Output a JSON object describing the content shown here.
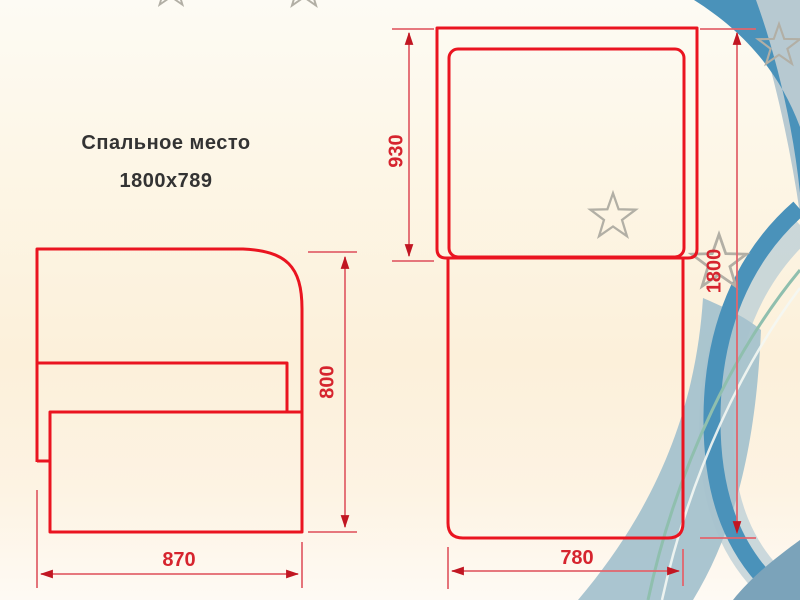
{
  "title": {
    "line1": "Спальное место",
    "line2": "1800x789"
  },
  "side_view": {
    "height_label": "800",
    "width_label": "870"
  },
  "top_view": {
    "upper_section_label": "930",
    "length_label": "1800",
    "width_label": "780"
  },
  "decor": {
    "star_icon": "star-outline",
    "star_count": 5
  },
  "colors": {
    "drawing_red": "#ea1420",
    "dimension_pink": "#e2656d",
    "arrow_red": "#c11622",
    "label_red": "#d6242e",
    "title_text": "#333333",
    "ribbon_dark": "#4a92ba",
    "ribbon_halo": "#b9cdd6",
    "ribbon_light": "#a5c2ce",
    "corner_light": "#b7c9d1",
    "corner_dark": "#7ba3ba",
    "teal_line": "#8fbfae",
    "white_line": "#f4f7f3",
    "star_gray": "#b2afa5"
  }
}
